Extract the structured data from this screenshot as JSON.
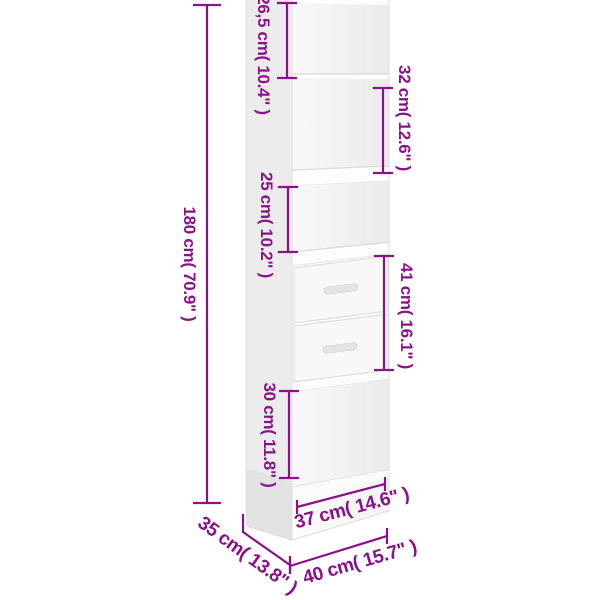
{
  "accent_color": "#8a118a",
  "product": {
    "kind": "book-cabinet",
    "panel_color": "#ffffff"
  },
  "annotations": {
    "height": {
      "label": "180 cm( 70.9\" )"
    },
    "top_section": {
      "label": "26,5 cm( 10.4\" )"
    },
    "second_section": {
      "label": "32 cm( 12.6\" )"
    },
    "third_section": {
      "label": "25 cm( 10.2\" )"
    },
    "drawer_section": {
      "label": "41 cm( 16.1\" )"
    },
    "bottom_section": {
      "label": "30 cm( 11.8\" )"
    },
    "inner_width": {
      "label": "37 cm( 14.6\" )"
    },
    "depth": {
      "label": "35 cm( 13.8\" )"
    },
    "width": {
      "label": "40 cm( 15.7\" )"
    }
  }
}
